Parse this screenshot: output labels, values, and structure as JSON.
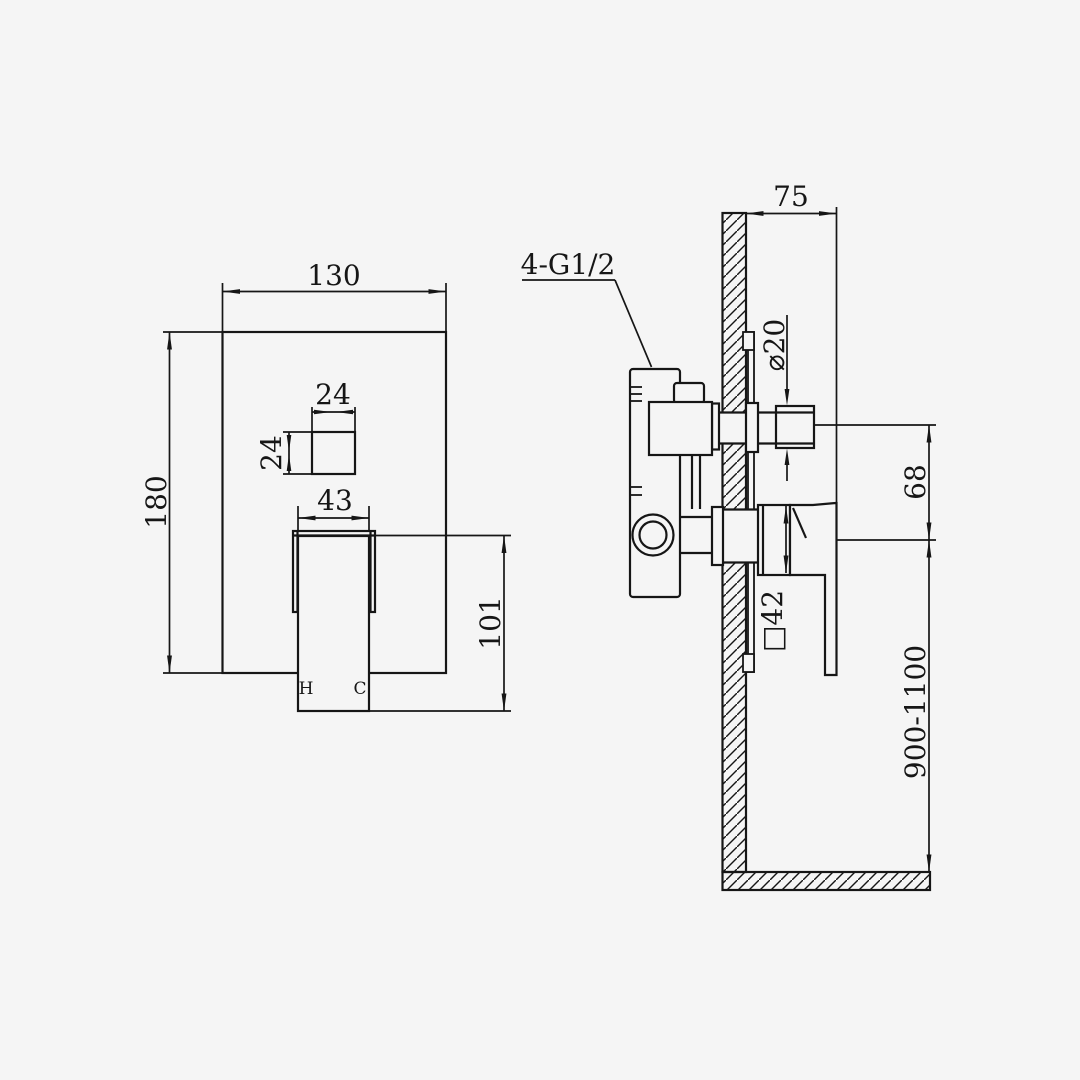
{
  "drawing": {
    "type": "installation-dimension-drawing",
    "subject": "concealed shower mixer valve",
    "background_color": "#f5f5f5",
    "line_color": "#161616",
    "front_view": {
      "dims": {
        "plate_width": "130",
        "plate_height": "180",
        "button_width": "24",
        "button_height": "24",
        "handle_width": "43",
        "handle_length": "101"
      },
      "labels": {
        "hot": "H",
        "cold": "C"
      }
    },
    "side_view": {
      "dims": {
        "wall_offset": "75",
        "spout_diameter": "⌀20",
        "outlet_spacing": "68",
        "trim_size": "□42",
        "install_height": "900-1100"
      },
      "labels": {
        "thread": "4-G1/2"
      }
    }
  }
}
